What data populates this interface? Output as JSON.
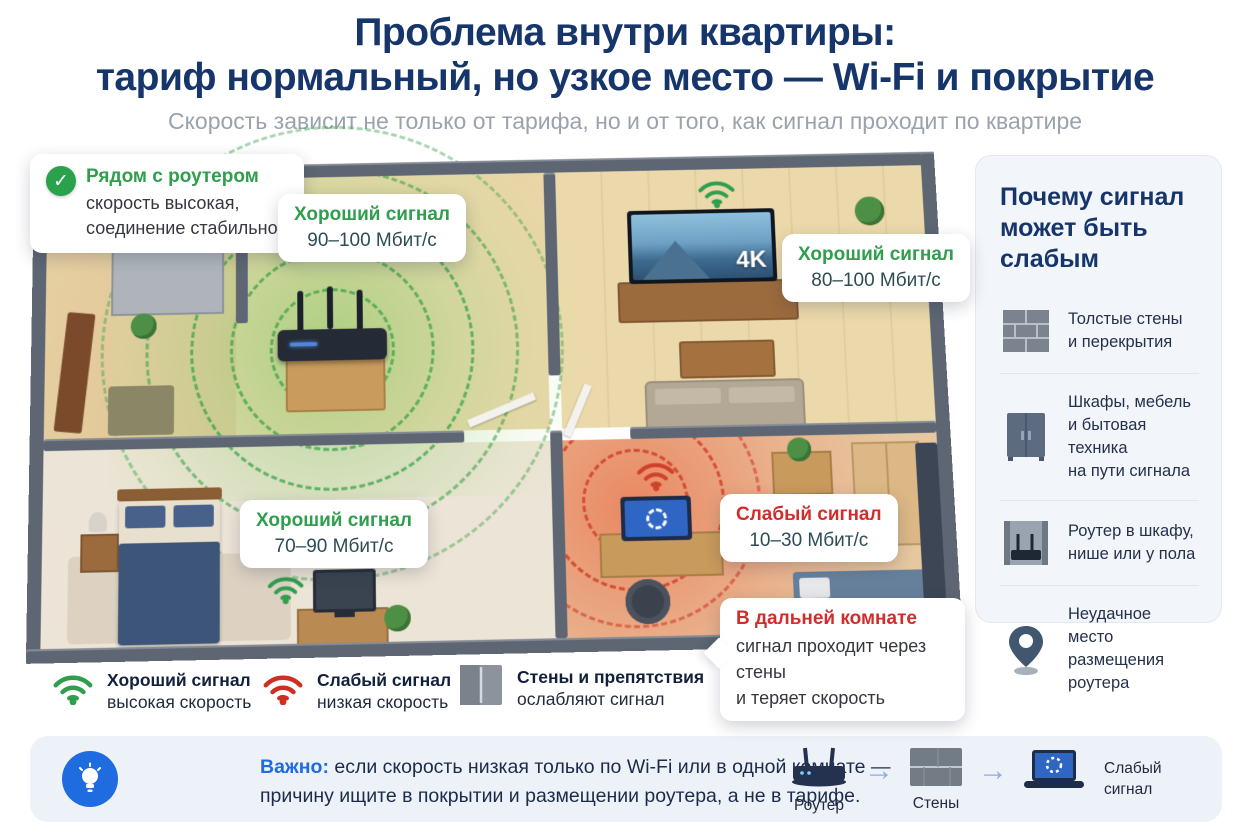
{
  "header": {
    "title_line1": "Проблема внутри квартиры:",
    "title_line2": "тариф нормальный, но узкое место — Wi-Fi и покрытие",
    "subtitle": "Скорость зависит не только от тарифа, но и от того, как сигнал проходит по квартире"
  },
  "floorplan": {
    "near_router_callout": {
      "title": "Рядом с роутером",
      "body": "скорость высокая,\nсоединение стабильное"
    },
    "signal_90": {
      "title": "Хороший сигнал",
      "value": "90–100 Мбит/с"
    },
    "signal_80": {
      "title": "Хороший сигнал",
      "value": "80–100 Мбит/с"
    },
    "signal_70": {
      "title": "Хороший сигнал",
      "value": "70–90 Мбит/с"
    },
    "signal_weak": {
      "title": "Слабый сигнал",
      "value": "10–30 Мбит/с"
    },
    "far_room_callout": {
      "title": "В дальней комнате",
      "body": "сигнал проходит через стены\nи теряет скорость"
    },
    "tv_badge": "4K"
  },
  "sidebar": {
    "title": "Почему сигнал\nможет быть слабым",
    "items": [
      {
        "icon": "brick-wall-icon",
        "text": "Толстые стены\nи перекрытия"
      },
      {
        "icon": "furniture-cabinet-icon",
        "text": "Шкафы, мебель\nи бытовая техника\nна пути сигнала"
      },
      {
        "icon": "router-in-niche-icon",
        "text": "Роутер в шкафу,\nнише или у пола"
      },
      {
        "icon": "location-pin-icon",
        "text": "Неудачное место\nразмещения роутера"
      }
    ]
  },
  "legend": {
    "good": {
      "title": "Хороший сигнал",
      "subtitle": "высокая скорость"
    },
    "weak": {
      "title": "Слабый сигнал",
      "subtitle": "низкая скорость"
    },
    "walls": {
      "title": "Стены и препятствия",
      "subtitle": "ослабляют сигнал"
    }
  },
  "important": {
    "label": "Важно:",
    "text": " если скорость низкая только по Wi-Fi или в одной комнате —\nпричину ищите в покрытии и размещении роутера, а не в тарифе."
  },
  "flow": {
    "router_label": "Роутер",
    "walls_label": "Стены",
    "result_label": "Слабый\nсигнал"
  },
  "colors": {
    "navy": "#16356b",
    "green": "#2f9e4d",
    "red": "#d22d2d",
    "blue": "#1f6be0",
    "subtitle_gray": "#9aa2ad",
    "wall_gray": "#5d6672"
  }
}
